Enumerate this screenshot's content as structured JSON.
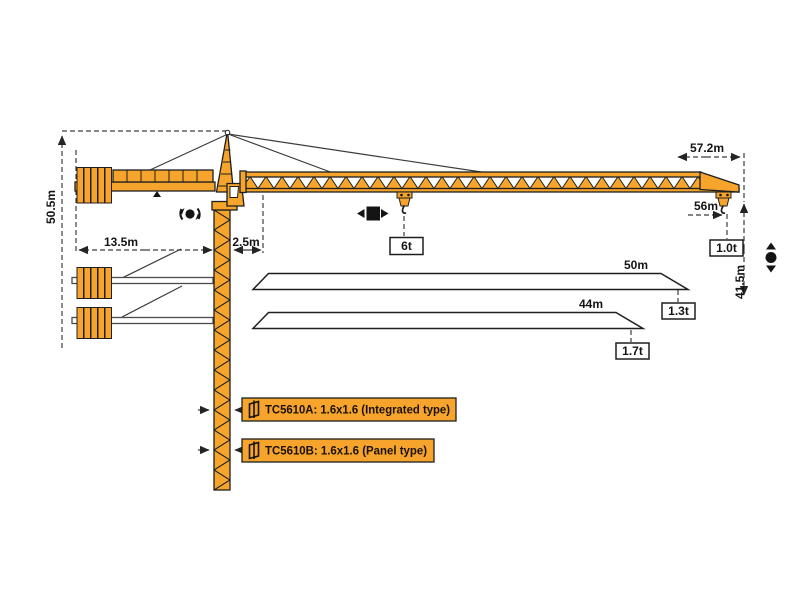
{
  "colors": {
    "orange": "#F6A42B",
    "outline": "#1f1f1f",
    "dim": "#3c3c3c"
  },
  "crane": {
    "dimensions": {
      "total_height": "50.5m",
      "counterjib_radius": "13.5m",
      "min_radius": "2.5m",
      "max_jib_radius": "57.2m",
      "tip_hook_radius": "56m",
      "hook_height": "41.5m"
    },
    "hooks": {
      "mid_load": "6t",
      "tip_load": "1.0t"
    },
    "jib_variants": [
      {
        "length": "50m",
        "tip_load": "1.3t"
      },
      {
        "length": "44m",
        "tip_load": "1.7t"
      }
    ],
    "mast_section_labels": [
      "TC5610A:  1.6x1.6  (Integrated type)",
      "TC5610B:  1.6x1.6  (Panel type)"
    ]
  }
}
